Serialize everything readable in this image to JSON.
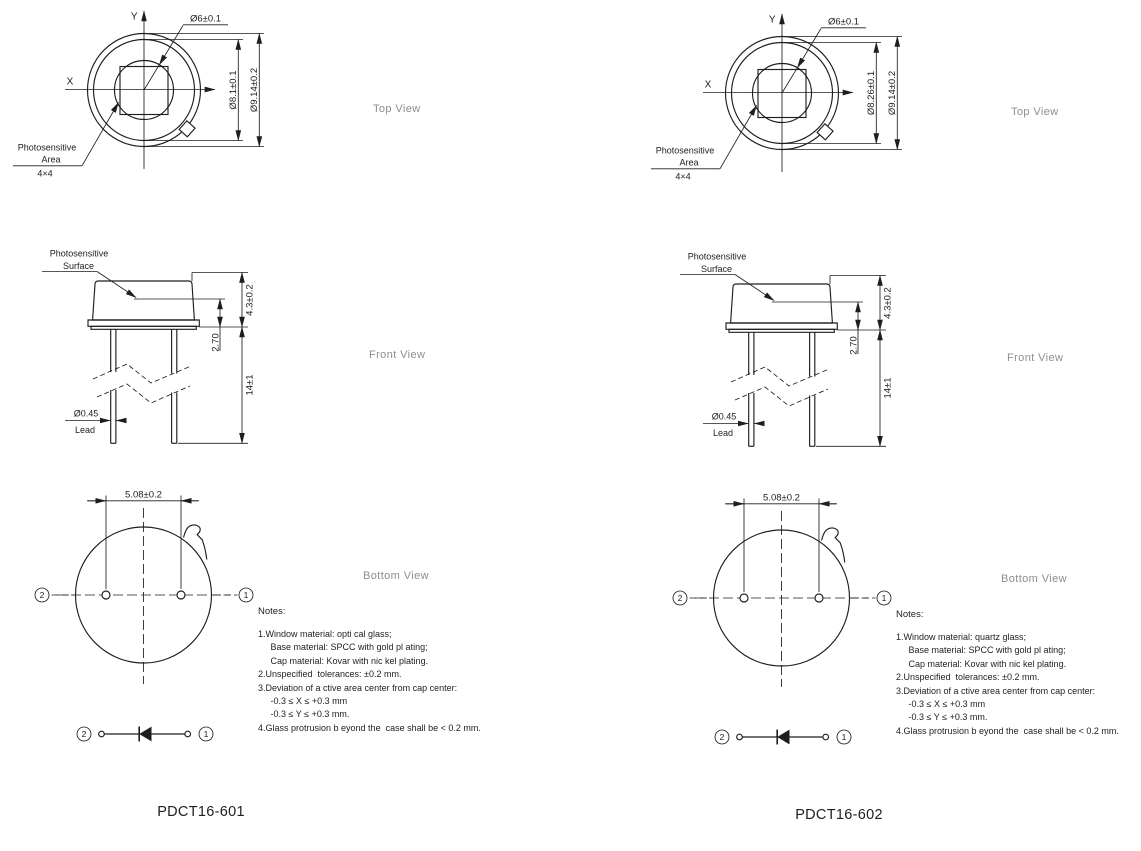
{
  "colors": {
    "line_color": "#1e1e1e",
    "muted_label_color": "#8d8d8d",
    "background": "#ffffff"
  },
  "panels": [
    {
      "part_number": "PDCT16-601",
      "views": {
        "top": "Top View",
        "front": "Front View",
        "bottom": "Bottom View"
      },
      "top_view": {
        "axis_x": "X",
        "axis_y": "Y",
        "window_dia": "Ø6±0.1",
        "cap_dia": "Ø8.1±0.1",
        "outer_dia": "Ø9.14±0.2",
        "area_label_1": "Photosensitive",
        "area_label_2": "Area",
        "area_size": "4×4"
      },
      "front_view": {
        "surface_label_1": "Photosensitive",
        "surface_label_2": "Surface",
        "cap_height": "4.3±0.2",
        "surface_height": "2.70",
        "lead_length": "14±1",
        "lead_dia": "Ø0.45",
        "lead_label": "Lead"
      },
      "bottom_view": {
        "pin_pitch": "5.08±0.2",
        "pin_1": "1",
        "pin_2": "2"
      },
      "schematic": {
        "pin_1": "1",
        "pin_2": "2"
      },
      "notes": {
        "title": "Notes:",
        "lines": [
          "1.Window material: opti cal glass;",
          "     Base material: SPCC with gold pl ating;",
          "     Cap material: Kovar with nic kel plating.",
          "2.Unspecified  tolerances: ±0.2 mm.",
          "3.Deviation of a ctive area center from cap center:",
          "     -0.3 ≤ X ≤ +0.3 mm",
          "     -0.3 ≤ Y ≤ +0.3 mm.",
          "4.Glass protrusion b eyond the  case shall be < 0.2 mm."
        ]
      }
    },
    {
      "part_number": "PDCT16-602",
      "views": {
        "top": "Top View",
        "front": "Front View",
        "bottom": "Bottom View"
      },
      "top_view": {
        "axis_x": "X",
        "axis_y": "Y",
        "window_dia": "Ø6±0.1",
        "cap_dia": "Ø8.26±0.1",
        "outer_dia": "Ø9.14±0.2",
        "area_label_1": "Photosensitive",
        "area_label_2": "Area",
        "area_size": "4×4"
      },
      "front_view": {
        "surface_label_1": "Photosensitive",
        "surface_label_2": "Surface",
        "cap_height": "4.3±0.2",
        "surface_height": "2.70",
        "lead_length": "14±1",
        "lead_dia": "Ø0.45",
        "lead_label": "Lead"
      },
      "bottom_view": {
        "pin_pitch": "5.08±0.2",
        "pin_1": "1",
        "pin_2": "2"
      },
      "schematic": {
        "pin_1": "1",
        "pin_2": "2"
      },
      "notes": {
        "title": "Notes:",
        "lines": [
          "1.Window material: quartz glass;",
          "     Base material: SPCC with gold pl ating;",
          "     Cap material: Kovar with nic kel plating.",
          "2.Unspecified  tolerances: ±0.2 mm.",
          "3.Deviation of a ctive area center from cap center:",
          "     -0.3 ≤ X ≤ +0.3 mm",
          "     -0.3 ≤ Y ≤ +0.3 mm.",
          "4.Glass protrusion b eyond the  case shall be < 0.2 mm."
        ]
      }
    }
  ]
}
